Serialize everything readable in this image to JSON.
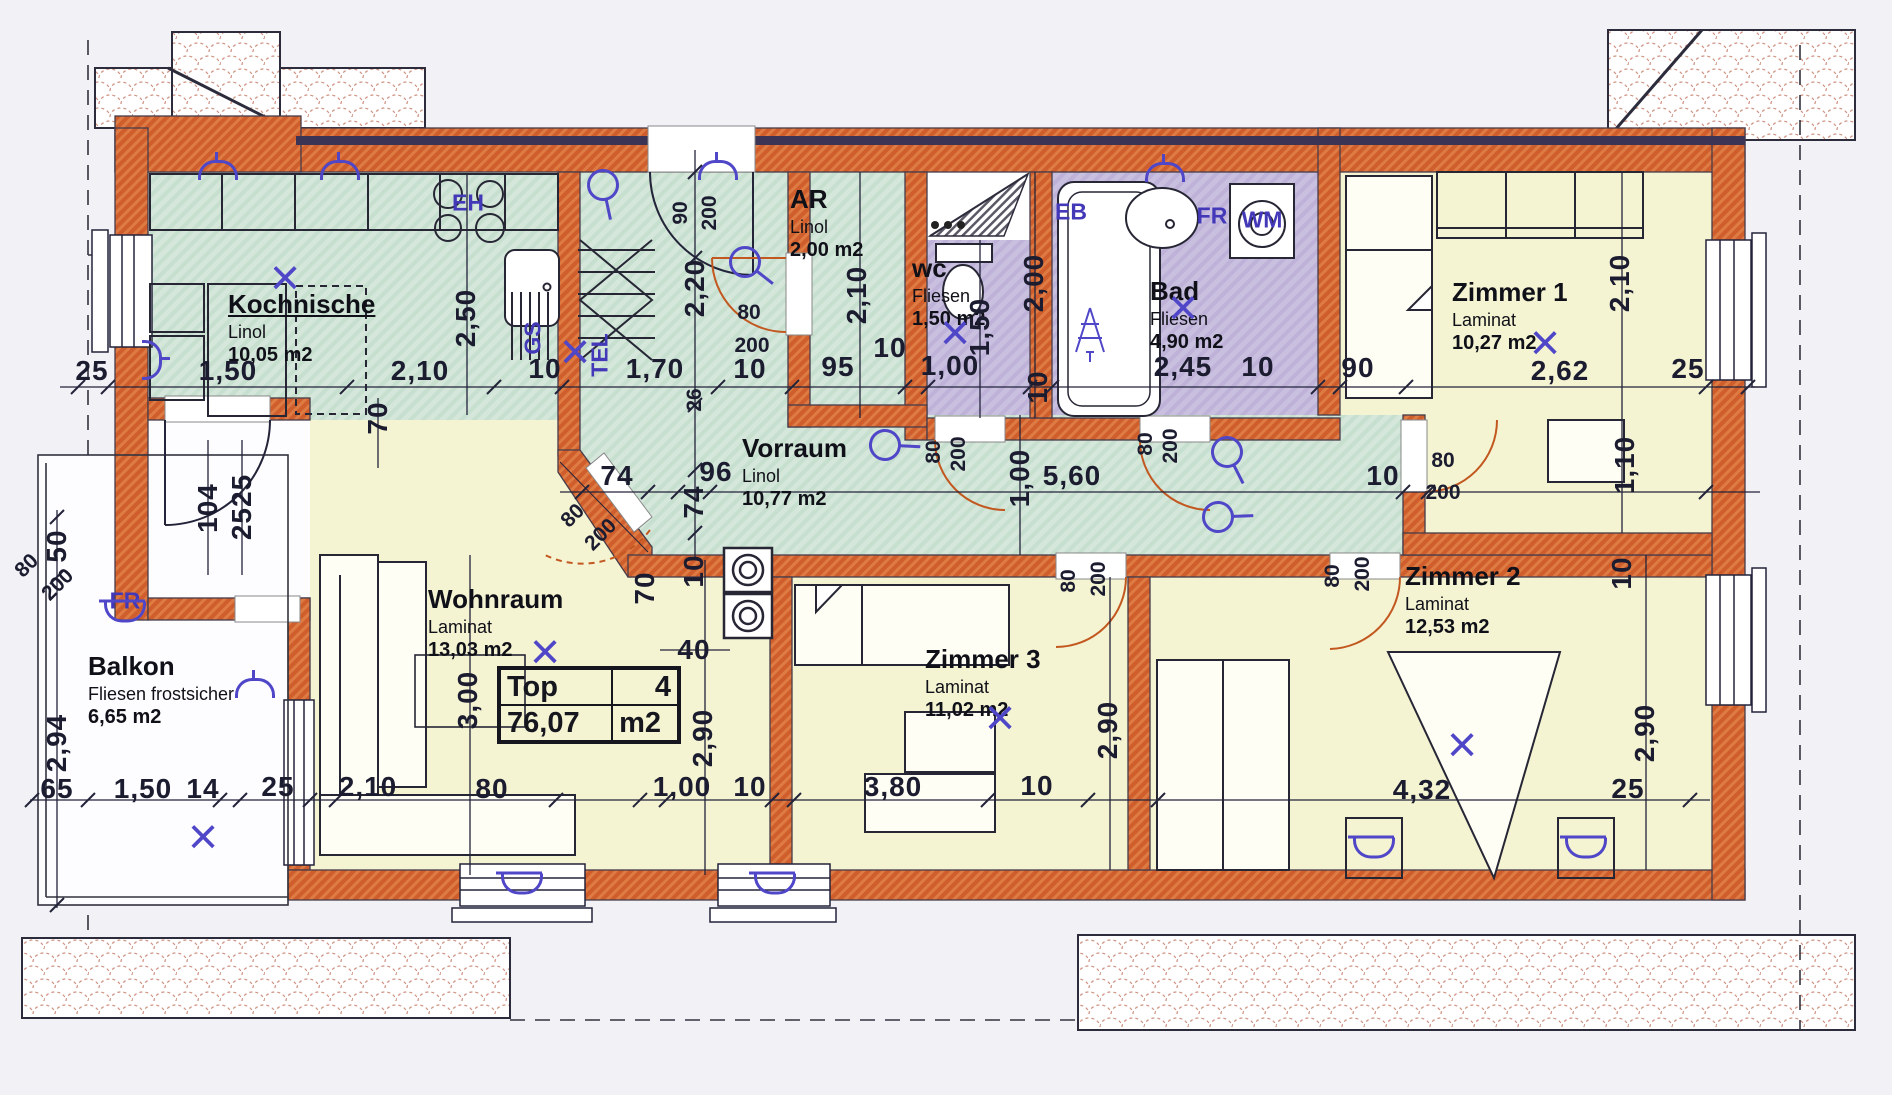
{
  "plan": {
    "title": "Wohnung Top 4 Grundriss",
    "unit_label": "m2",
    "rooms": [
      {
        "name": "Kochnische",
        "material": "Linol",
        "area": "10,05 m2"
      },
      {
        "name": "AR",
        "material": "Linol",
        "area": "2,00 m2"
      },
      {
        "name": "wc",
        "material": "Fliesen",
        "area": "1,50 m2"
      },
      {
        "name": "Bad",
        "material": "Fliesen",
        "area": "4,90 m2"
      },
      {
        "name": "Zimmer 1",
        "material": "Laminat",
        "area": "10,27 m2"
      },
      {
        "name": "Vorraum",
        "material": "Linol",
        "area": "10,77 m2"
      },
      {
        "name": "Wohnraum",
        "material": "Laminat",
        "area": "13,03 m2"
      },
      {
        "name": "Zimmer 3",
        "material": "Laminat",
        "area": "11,02 m2"
      },
      {
        "name": "Zimmer 2",
        "material": "Laminat",
        "area": "12,53 m2"
      },
      {
        "name": "Balkon",
        "material": "Fliesen frostsicher",
        "area": "6,65 m2"
      }
    ],
    "top_label": {
      "name": "Top",
      "number": "4",
      "area": "76,07",
      "unit": "m2"
    },
    "fixture_labels": [
      {
        "t": "GS",
        "x": 533,
        "y": 338,
        "r": -90
      },
      {
        "t": "TEL",
        "x": 600,
        "y": 355,
        "r": -90
      },
      {
        "t": "FR",
        "x": 125,
        "y": 601
      },
      {
        "t": "FR",
        "x": 1212,
        "y": 216
      },
      {
        "t": "WM",
        "x": 1262,
        "y": 220
      },
      {
        "t": "EB",
        "x": 1071,
        "y": 212
      },
      {
        "t": "EH",
        "x": 468,
        "y": 203
      }
    ],
    "dimensions": [
      {
        "t": "25",
        "x": 92,
        "y": 371
      },
      {
        "t": "1,50",
        "x": 228,
        "y": 371
      },
      {
        "t": "2,10",
        "x": 420,
        "y": 371
      },
      {
        "t": "10",
        "x": 545,
        "y": 369
      },
      {
        "t": "1,70",
        "x": 655,
        "y": 369
      },
      {
        "t": "10",
        "x": 750,
        "y": 369
      },
      {
        "t": "95",
        "x": 838,
        "y": 367
      },
      {
        "t": "10",
        "x": 890,
        "y": 348
      },
      {
        "t": "1,00",
        "x": 950,
        "y": 366
      },
      {
        "t": "10",
        "x": 1038,
        "y": 387,
        "r": -90
      },
      {
        "t": "2,45",
        "x": 1183,
        "y": 367
      },
      {
        "t": "10",
        "x": 1258,
        "y": 367
      },
      {
        "t": "90",
        "x": 1358,
        "y": 368
      },
      {
        "t": "2,62",
        "x": 1560,
        "y": 371
      },
      {
        "t": "25",
        "x": 1688,
        "y": 369
      },
      {
        "t": "2,50",
        "x": 466,
        "y": 318,
        "r": -90
      },
      {
        "t": "90",
        "x": 681,
        "y": 213,
        "r": -90,
        "s": 1
      },
      {
        "t": "200",
        "x": 710,
        "y": 213,
        "r": -90,
        "s": 1
      },
      {
        "t": "2,20",
        "x": 695,
        "y": 288,
        "r": -90
      },
      {
        "t": "2,10",
        "x": 857,
        "y": 295,
        "r": -90
      },
      {
        "t": "1,50",
        "x": 980,
        "y": 327,
        "r": -90
      },
      {
        "t": "2,00",
        "x": 1034,
        "y": 283,
        "r": -90
      },
      {
        "t": "2,10",
        "x": 1620,
        "y": 283,
        "r": -90
      },
      {
        "t": "80",
        "x": 749,
        "y": 313,
        "s": 1
      },
      {
        "t": "200",
        "x": 752,
        "y": 346,
        "s": 1
      },
      {
        "t": "74",
        "x": 617,
        "y": 476
      },
      {
        "t": "26",
        "x": 695,
        "y": 400,
        "r": -90,
        "s": 1
      },
      {
        "t": "74",
        "x": 694,
        "y": 502,
        "r": -90
      },
      {
        "t": "96",
        "x": 716,
        "y": 472
      },
      {
        "t": "1,00",
        "x": 1020,
        "y": 478,
        "r": -90
      },
      {
        "t": "5,60",
        "x": 1072,
        "y": 476
      },
      {
        "t": "10",
        "x": 1383,
        "y": 476
      },
      {
        "t": "1,10",
        "x": 1625,
        "y": 465,
        "r": -90
      },
      {
        "t": "10",
        "x": 1622,
        "y": 573,
        "r": -90
      },
      {
        "t": "80",
        "x": 934,
        "y": 452,
        "r": -90,
        "s": 1
      },
      {
        "t": "200",
        "x": 959,
        "y": 454,
        "r": -90,
        "s": 1
      },
      {
        "t": "80",
        "x": 1146,
        "y": 444,
        "r": -90,
        "s": 1
      },
      {
        "t": "200",
        "x": 1171,
        "y": 446,
        "r": -90,
        "s": 1
      },
      {
        "t": "80",
        "x": 1443,
        "y": 461,
        "s": 1
      },
      {
        "t": "200",
        "x": 1443,
        "y": 493,
        "s": 1
      },
      {
        "t": "80",
        "x": 1069,
        "y": 581,
        "r": -90,
        "s": 1
      },
      {
        "t": "200",
        "x": 1099,
        "y": 579,
        "r": -90,
        "s": 1
      },
      {
        "t": "80",
        "x": 1333,
        "y": 576,
        "r": -90,
        "s": 1
      },
      {
        "t": "200",
        "x": 1363,
        "y": 574,
        "r": -90,
        "s": 1
      },
      {
        "t": "80",
        "x": 573,
        "y": 516,
        "r": -45,
        "s": 1
      },
      {
        "t": "200",
        "x": 601,
        "y": 535,
        "r": -45,
        "s": 1
      },
      {
        "t": "80",
        "x": 27,
        "y": 566,
        "r": -45,
        "s": 1
      },
      {
        "t": "200",
        "x": 58,
        "y": 585,
        "r": -45,
        "s": 1
      },
      {
        "t": "104",
        "x": 208,
        "y": 508,
        "r": -90
      },
      {
        "t": "2525",
        "x": 242,
        "y": 507,
        "r": -90
      },
      {
        "t": "3,00",
        "x": 468,
        "y": 700,
        "r": -90
      },
      {
        "t": "70",
        "x": 378,
        "y": 418,
        "r": -90
      },
      {
        "t": "70",
        "x": 645,
        "y": 588,
        "r": -90
      },
      {
        "t": "10",
        "x": 694,
        "y": 571,
        "r": -90
      },
      {
        "t": "40",
        "x": 694,
        "y": 650
      },
      {
        "t": "2,90",
        "x": 703,
        "y": 738,
        "r": -90
      },
      {
        "t": "2,90",
        "x": 1108,
        "y": 730,
        "r": -90
      },
      {
        "t": "2,90",
        "x": 1645,
        "y": 733,
        "r": -90
      },
      {
        "t": "4,32",
        "x": 1422,
        "y": 790
      },
      {
        "t": "25",
        "x": 1628,
        "y": 789
      },
      {
        "t": "50",
        "x": 57,
        "y": 546,
        "r": -90
      },
      {
        "t": "2,94",
        "x": 57,
        "y": 743,
        "r": -90
      },
      {
        "t": "65",
        "x": 57,
        "y": 789
      },
      {
        "t": "1,50",
        "x": 143,
        "y": 789
      },
      {
        "t": "14",
        "x": 203,
        "y": 789
      },
      {
        "t": "25",
        "x": 278,
        "y": 787
      },
      {
        "t": "2,10",
        "x": 368,
        "y": 787
      },
      {
        "t": "80",
        "x": 492,
        "y": 789
      },
      {
        "t": "1,00",
        "x": 682,
        "y": 787
      },
      {
        "t": "10",
        "x": 750,
        "y": 787
      },
      {
        "t": "3,80",
        "x": 893,
        "y": 787
      },
      {
        "t": "10",
        "x": 1037,
        "y": 786
      }
    ],
    "symbols": [
      {
        "t": "x",
        "x": 285,
        "y": 278
      },
      {
        "t": "x",
        "x": 575,
        "y": 352
      },
      {
        "t": "x",
        "x": 955,
        "y": 333
      },
      {
        "t": "x",
        "x": 1183,
        "y": 308
      },
      {
        "t": "x",
        "x": 1545,
        "y": 343
      },
      {
        "t": "x",
        "x": 545,
        "y": 652
      },
      {
        "t": "x",
        "x": 1000,
        "y": 718
      },
      {
        "t": "x",
        "x": 1462,
        "y": 745
      },
      {
        "t": "x",
        "x": 203,
        "y": 837
      },
      {
        "t": "switch",
        "x": 603,
        "y": 185,
        "r": 40
      },
      {
        "t": "switch",
        "x": 745,
        "y": 262,
        "r": 0
      },
      {
        "t": "switch",
        "x": 885,
        "y": 445,
        "r": -35
      },
      {
        "t": "switch",
        "x": 1227,
        "y": 452,
        "r": 25
      },
      {
        "t": "switch",
        "x": 1218,
        "y": 517,
        "r": -40
      },
      {
        "t": "socket",
        "x": 218,
        "y": 170,
        "r": 0
      },
      {
        "t": "socket",
        "x": 340,
        "y": 170,
        "r": 0
      },
      {
        "t": "socket",
        "x": 718,
        "y": 170,
        "r": 0
      },
      {
        "t": "socket",
        "x": 1165,
        "y": 172,
        "r": 0
      },
      {
        "t": "socket",
        "x": 152,
        "y": 360,
        "r": 90
      },
      {
        "t": "socket",
        "x": 255,
        "y": 688,
        "r": 0
      },
      {
        "t": "heater",
        "x": 522,
        "y": 884,
        "r": 0
      },
      {
        "t": "heater",
        "x": 775,
        "y": 884,
        "r": 0
      },
      {
        "t": "heater",
        "x": 125,
        "y": 612,
        "r": 0
      },
      {
        "t": "heater",
        "x": 1374,
        "y": 848,
        "r": 0
      },
      {
        "t": "heater",
        "x": 1586,
        "y": 848,
        "r": 0
      }
    ],
    "colors": {
      "wall": "#cf5e2c",
      "green_floor": "#d4e7da",
      "yellow_floor": "#f4f3d2",
      "purple_floor": "#c9c0e0",
      "annotation_blue": "#4a3fc0",
      "line": "#23233a"
    }
  }
}
